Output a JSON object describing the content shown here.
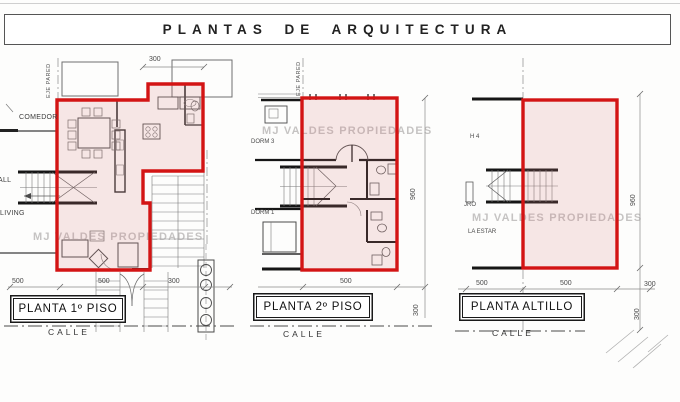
{
  "title": "PLANTAS DE ARQUITECTURA",
  "watermark": "MJ VALDES PROPIEDADES",
  "colors": {
    "outline": "#d31414",
    "region_fill": "#f6e4e4",
    "drawing_line": "#4a4a4a",
    "watermark_gray": "#a3a0a0"
  },
  "plans": [
    {
      "name": "PLANTA 1º PISO",
      "axis_label": "EJE PARED",
      "street_label": "CALLE",
      "room_labels": {
        "comedor": "COMEDOR",
        "hall": "ALL",
        "living": "LIVING"
      },
      "dims": {
        "top": "300",
        "bottom_left": "500",
        "bottom_mid": "500",
        "bottom_right": "300"
      }
    },
    {
      "name": "PLANTA 2º PISO",
      "axis_label": "EJE PARED",
      "street_label": "CALLE",
      "room_labels": {
        "dorm3": "DORM 3",
        "dorm1": "DORM 1"
      },
      "dims": {
        "bottom": "500",
        "right": "960",
        "bottom_right_vert": "300"
      }
    },
    {
      "name": "PLANTA ALTILLO",
      "street_label": "CALLE",
      "room_labels": {
        "h4": "H 4",
        "jro": "JRO",
        "la_estar": "LA ESTAR"
      },
      "dims": {
        "bottom_left": "500",
        "bottom_mid": "500",
        "bottom_right": "300",
        "right": "960",
        "right_lower": "300"
      }
    }
  ]
}
